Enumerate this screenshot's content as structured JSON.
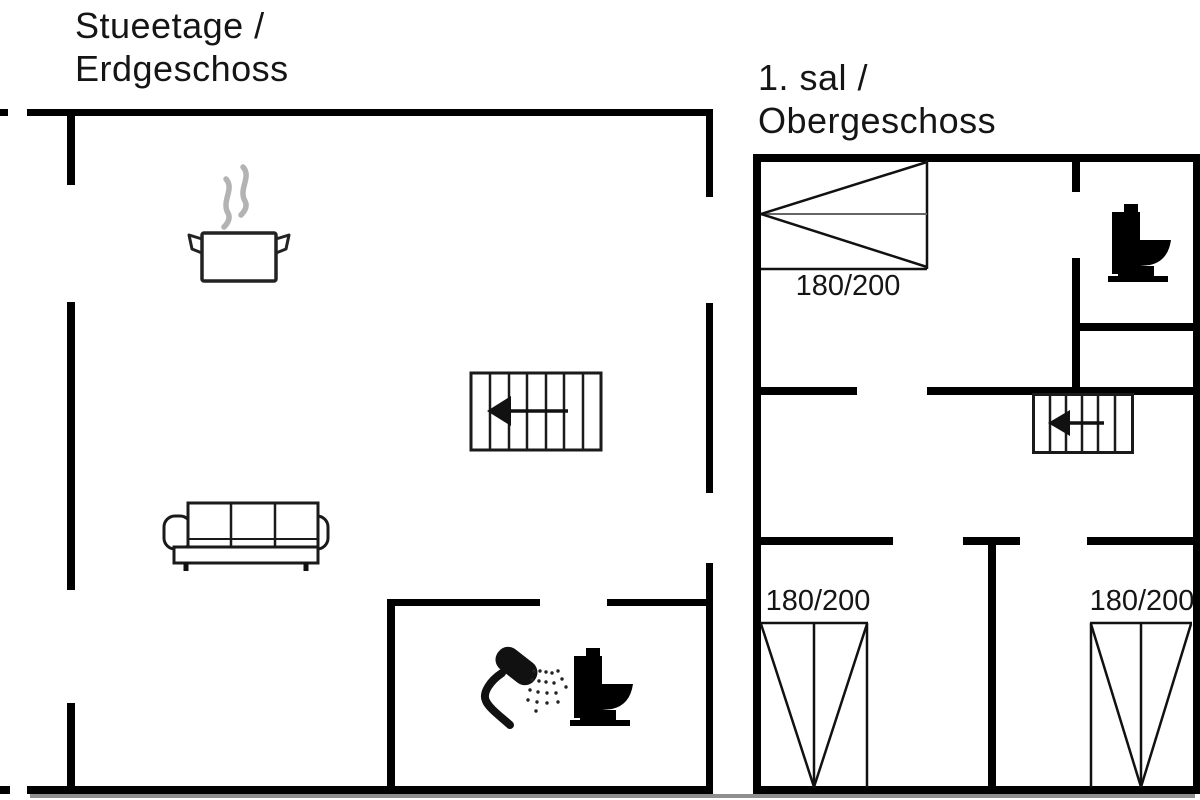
{
  "background": "#ffffff",
  "wall_color": "#000000",
  "line_color": "#1a1a1a",
  "steam_color": "#b3b3b3",
  "left_plan": {
    "title_line1": "Stueetage /",
    "title_line2": "Erdgeschoss"
  },
  "right_plan": {
    "title_line1": "1. sal /",
    "title_line2": "Obergeschoss",
    "double_bed_label": "180/200",
    "bottom_left_bed_label": "180/200",
    "bottom_right_bed_label": "180/200"
  },
  "icons": {
    "cooking_pot": "steaming-pot",
    "stairs_ground_floor": "stairs-with-left-arrow",
    "sofa": "three-seat-sofa",
    "shower": "handheld-shower-with-spray",
    "toilet_ground_floor": "toilet-side-view",
    "toilet_upper_floor": "toilet-side-view",
    "stairs_upper_floor": "stairs-with-left-arrow",
    "double_bed": "double-bed-floorplan-symbol",
    "single_bed_bottom_left": "bed-floorplan-symbol",
    "single_bed_bottom_right": "bed-floorplan-symbol"
  }
}
